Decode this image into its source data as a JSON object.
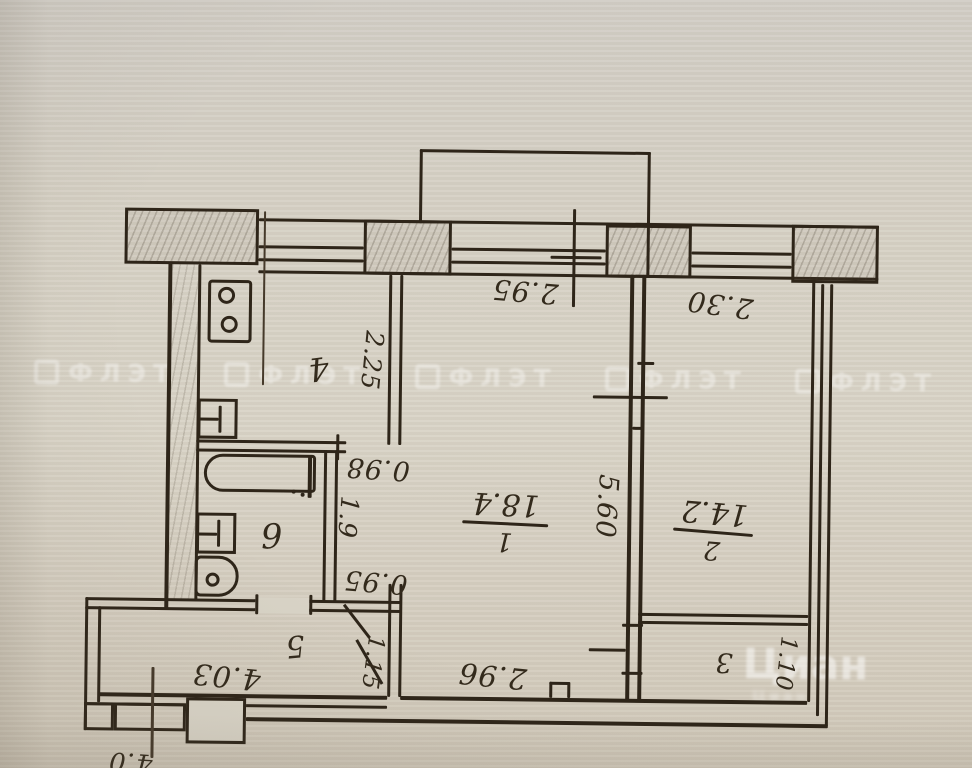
{
  "document": {
    "kind": "scanned hand-drawn apartment floor plan, sheet rotated 180 degrees"
  },
  "watermarks": {
    "band_text": "ФЛЭТ",
    "corner_text": "Циан"
  },
  "rooms": {
    "room1": {
      "number": "1",
      "area": "18.4"
    },
    "room2": {
      "number": "2",
      "area": "14.2"
    },
    "room3": {
      "number": "3"
    },
    "room4": {
      "number": "4"
    },
    "room5": {
      "number": "5"
    },
    "room6": {
      "number": "6"
    }
  },
  "dimensions": {
    "top_window_center": "2.95",
    "top_window_right": "2.30",
    "kitchen_width": "2.25",
    "kitchen_opening": "0.98",
    "bath_width": "1.9",
    "bath_opening": "0.95",
    "room_depth": "5.60",
    "hall_length": "4.03",
    "hall_width": "1.15",
    "bottom_center": "2.96",
    "balcony_width": "1.10",
    "corner_note": "4.0"
  }
}
